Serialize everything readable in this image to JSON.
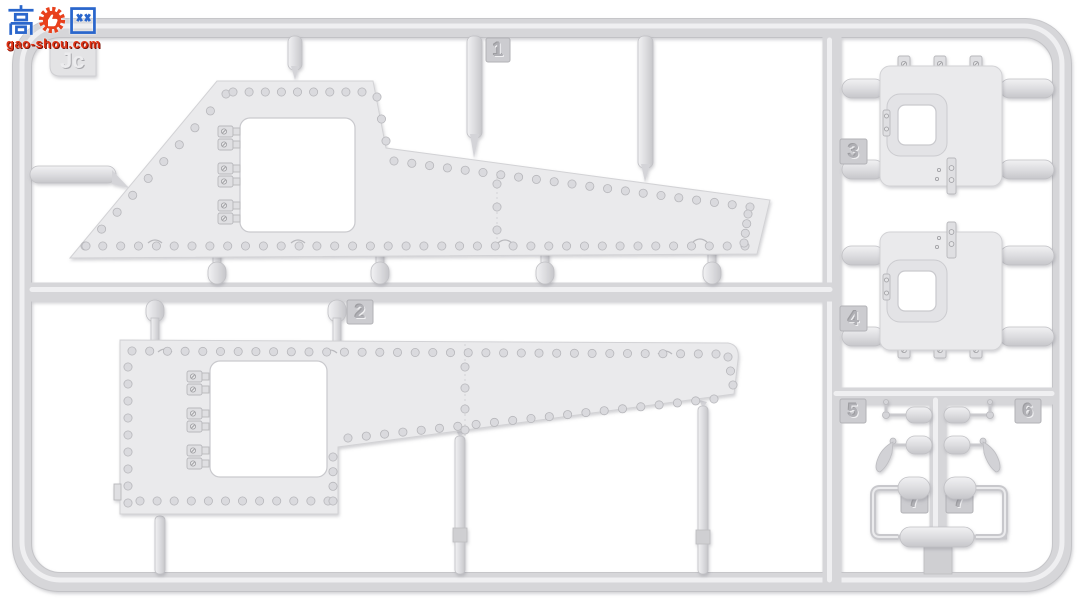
{
  "image_type": "photo of a light-gray plastic model kit sprue (injection-molded parts tree)",
  "watermark": {
    "char_left": "高",
    "char_right": "网",
    "site": "gao-shou.com",
    "blue": "#2a66cc",
    "red": "#e03315"
  },
  "sprue": {
    "letter": "Jc",
    "plastic_color": "#dcdcdf",
    "background": "#ffffff",
    "part_numbers_visible": [
      "1",
      "2",
      "3",
      "4",
      "5",
      "6",
      "7",
      "7"
    ],
    "part_tags": [
      {
        "label": "1",
        "x": 486,
        "y": 38,
        "w": 24,
        "h": 24
      },
      {
        "label": "2",
        "x": 347,
        "y": 300,
        "w": 26,
        "h": 24
      },
      {
        "label": "3",
        "x": 840,
        "y": 139,
        "w": 27,
        "h": 25
      },
      {
        "label": "4",
        "x": 840,
        "y": 306,
        "w": 27,
        "h": 25
      },
      {
        "label": "5",
        "x": 840,
        "y": 399,
        "w": 26,
        "h": 24
      },
      {
        "label": "6",
        "x": 1015,
        "y": 399,
        "w": 26,
        "h": 24
      },
      {
        "label": "7",
        "x": 901,
        "y": 486,
        "w": 27,
        "h": 27
      },
      {
        "label": "7",
        "x": 946,
        "y": 486,
        "w": 27,
        "h": 27
      }
    ],
    "render": {
      "rivet_r": 4.1,
      "rivet_runs": [
        {
          "x1": 85,
          "y1": 246,
          "x2": 745,
          "y2": 246,
          "n": 38
        },
        {
          "x1": 86,
          "y1": 246,
          "x2": 226,
          "y2": 94,
          "n": 10
        },
        {
          "x1": 233,
          "y1": 92,
          "x2": 362,
          "y2": 92,
          "n": 9
        },
        {
          "x1": 377,
          "y1": 97,
          "x2": 386,
          "y2": 141,
          "n": 3
        },
        {
          "x1": 394,
          "y1": 161,
          "x2": 750,
          "y2": 207,
          "n": 21
        },
        {
          "x1": 748,
          "y1": 214,
          "x2": 744,
          "y2": 243,
          "n": 4
        },
        {
          "x1": 497,
          "y1": 184,
          "x2": 497,
          "y2": 230,
          "n": 3
        },
        {
          "x1": 132,
          "y1": 351,
          "x2": 716,
          "y2": 354,
          "n": 34
        },
        {
          "x1": 128,
          "y1": 367,
          "x2": 128,
          "y2": 503,
          "n": 9
        },
        {
          "x1": 140,
          "y1": 501,
          "x2": 328,
          "y2": 501,
          "n": 12
        },
        {
          "x1": 333,
          "y1": 457,
          "x2": 333,
          "y2": 501,
          "n": 4
        },
        {
          "x1": 348,
          "y1": 438,
          "x2": 714,
          "y2": 399,
          "n": 21
        },
        {
          "x1": 728,
          "y1": 357,
          "x2": 733,
          "y2": 385,
          "n": 3
        },
        {
          "x1": 465,
          "y1": 367,
          "x2": 465,
          "y2": 430,
          "n": 4
        }
      ]
    }
  }
}
